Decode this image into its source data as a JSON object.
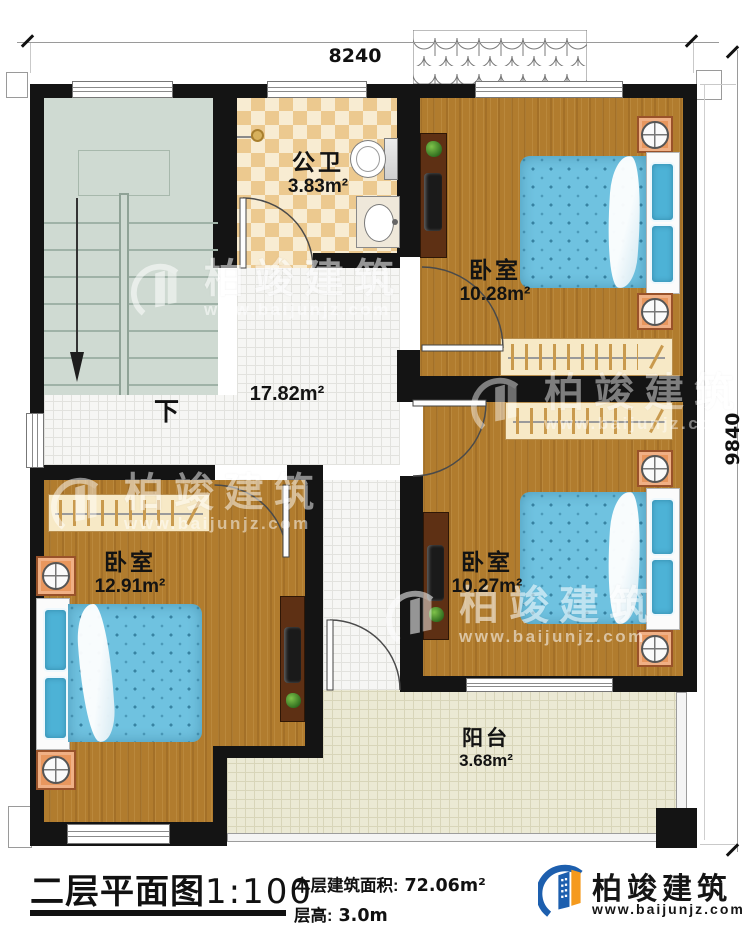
{
  "dimensions": {
    "width": "8240",
    "height": "9840"
  },
  "rooms": {
    "bathroom": {
      "name": "公卫",
      "area": "3.83m²"
    },
    "hall": {
      "area": "17.82m²"
    },
    "stairs": {
      "down": "下"
    },
    "bedroom_top_right": {
      "name": "卧室",
      "area": "10.28m²"
    },
    "bedroom_bottom_left": {
      "name": "卧室",
      "area": "12.91m²"
    },
    "bedroom_bottom_right": {
      "name": "卧室",
      "area": "10.27m²"
    },
    "balcony": {
      "name": "阳台",
      "area": "3.68m²"
    }
  },
  "footer": {
    "title": "二层平面图",
    "scale": "1:100",
    "area_label": "本层建筑面积:",
    "area_value": "72.06m²",
    "floor_height_label": "层高:",
    "floor_height_value": "3.0m"
  },
  "brand": {
    "name": "柏竣建筑",
    "website": "www.baijunjz.com"
  },
  "watermark": {
    "name": "柏竣建筑",
    "website": "www.baijunjz.com"
  },
  "colors": {
    "wall": "#141414",
    "wood": "#b17c2e",
    "stairs": "#cfdad2",
    "checker_dark": "#ecc98f",
    "checker_light": "#f8ecd2",
    "tile_hall": "#f6f6f4",
    "tile_balcony": "#ebe9d4",
    "bed": "#6fc2e0",
    "nightstand": "#e8975e",
    "accent_blue": "#1d5fae",
    "accent_orange": "#f59a1d"
  }
}
